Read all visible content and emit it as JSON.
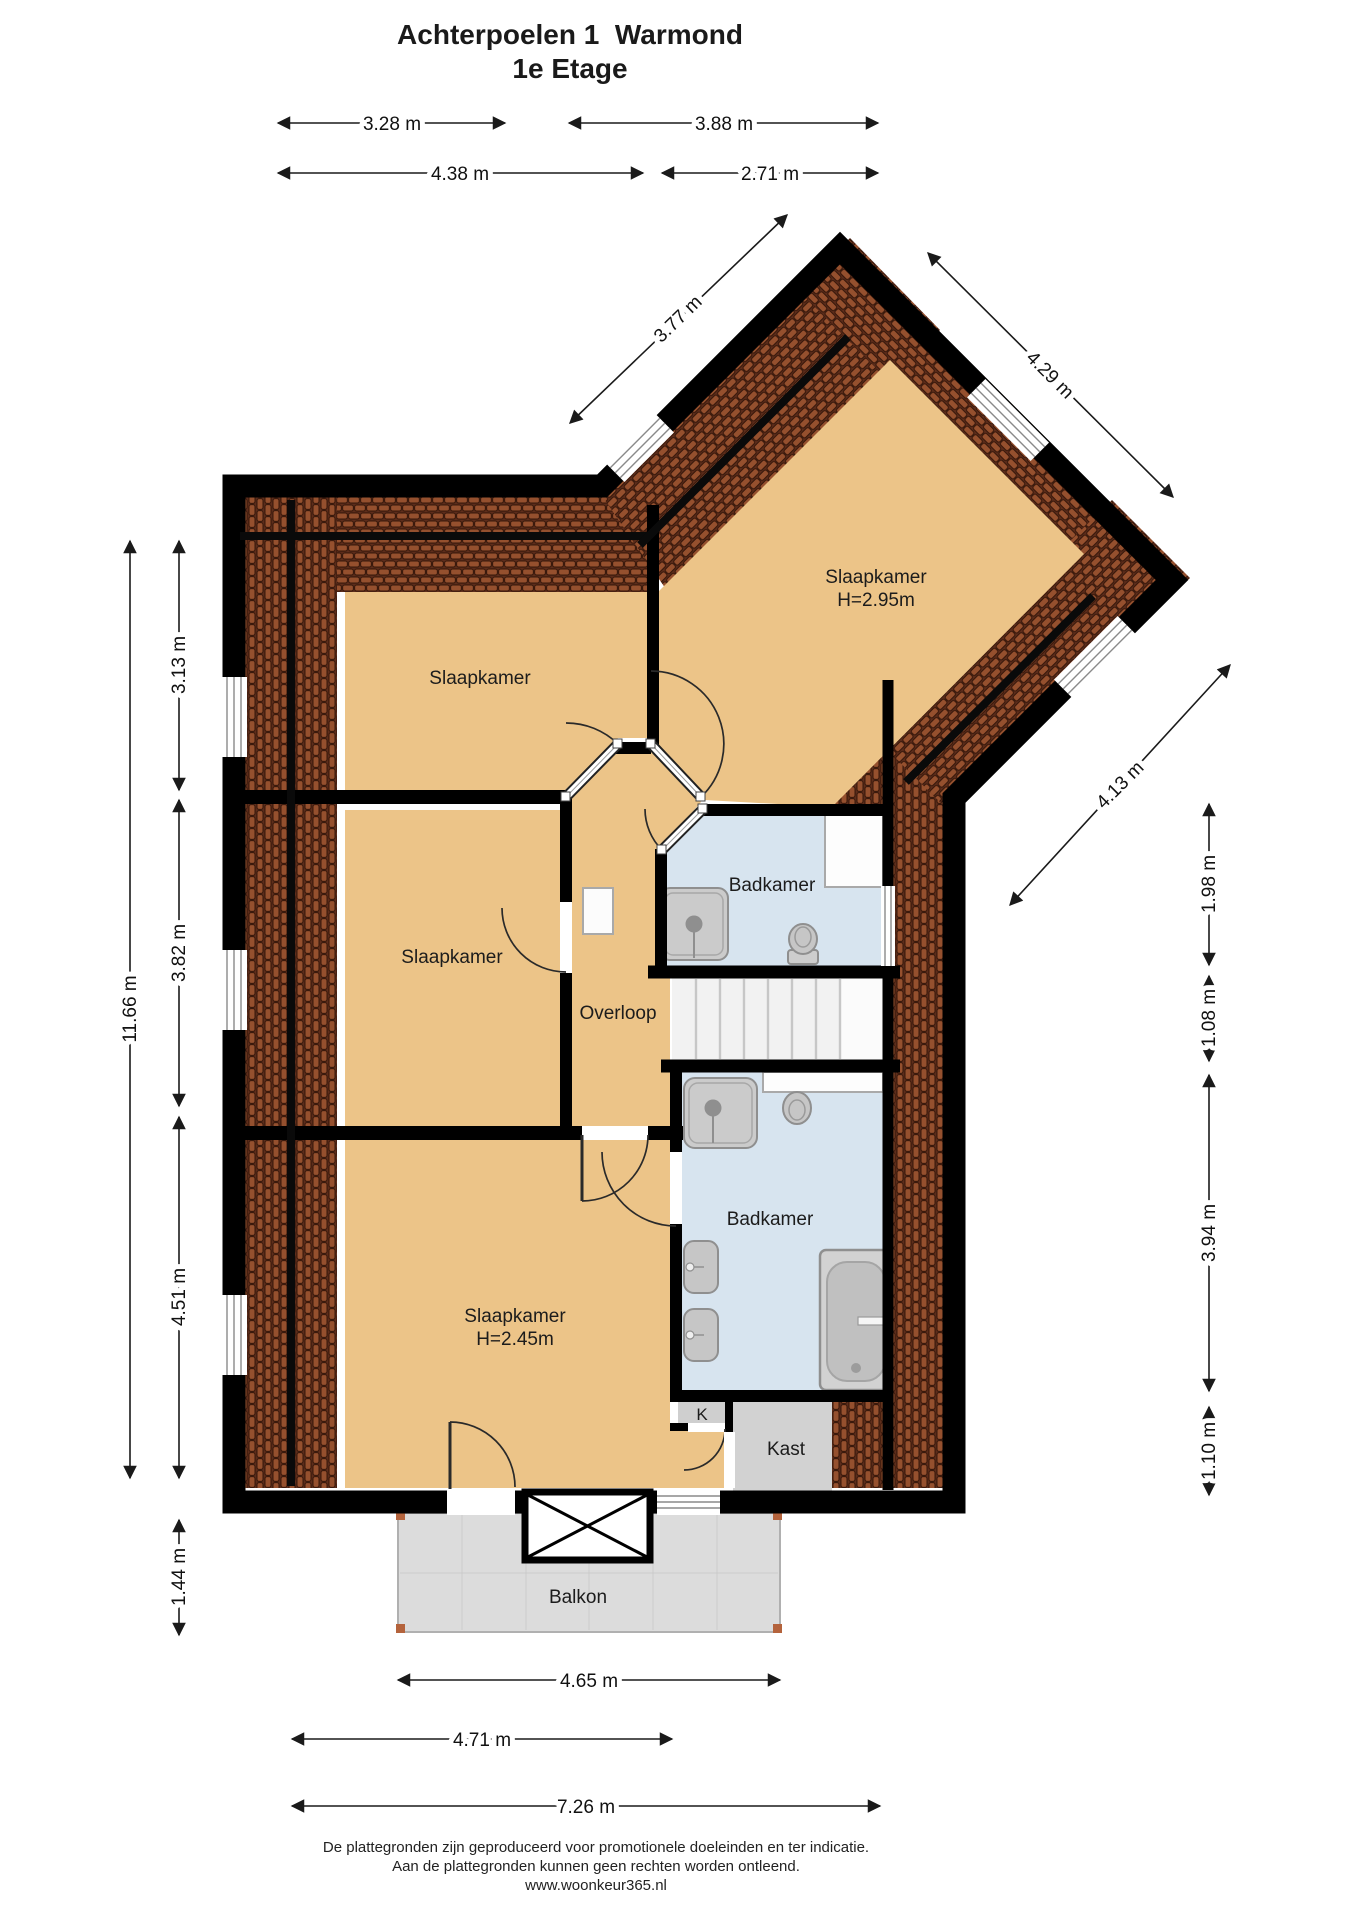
{
  "title": {
    "line1": "Achterpoelen 1  Warmond",
    "line2": "1e Etage"
  },
  "rooms": [
    {
      "name": "bedroom-top-left",
      "label": "Slaapkamer"
    },
    {
      "name": "bedroom-wing",
      "label": "Slaapkamer",
      "height": "H=2.95m"
    },
    {
      "name": "bedroom-middle-left",
      "label": "Slaapkamer"
    },
    {
      "name": "landing",
      "label": "Overloop"
    },
    {
      "name": "bathroom-top",
      "label": "Badkamer"
    },
    {
      "name": "bathroom-bottom",
      "label": "Badkamer"
    },
    {
      "name": "bedroom-large",
      "label": "Slaapkamer",
      "height": "H=2.45m"
    },
    {
      "name": "closet-small",
      "label": "K"
    },
    {
      "name": "closet",
      "label": "Kast"
    },
    {
      "name": "balcony",
      "label": "Balkon"
    }
  ],
  "dims": {
    "top": [
      "3.28 m",
      "3.88 m",
      "4.38 m",
      "2.71 m"
    ],
    "left": [
      "11.66 m",
      "3.13 m",
      "3.82 m",
      "4.51 m",
      "1.44 m"
    ],
    "right": [
      "1.98 m",
      "1.08 m",
      "3.94 m",
      "1.10 m"
    ],
    "bottom": [
      "4.65 m",
      "4.71 m",
      "7.26 m"
    ],
    "diagonal": [
      "3.77 m",
      "4.29 m",
      "4.13 m"
    ]
  },
  "footer": {
    "line1": "De plattegronden zijn geproduceerd voor promotionele doeleinden en ter indicatie.",
    "line2": "Aan de plattegronden kunnen geen rechten worden ontleend.",
    "line3": "www.woonkeur365.nl"
  },
  "colors": {
    "wall": "#000000",
    "floor_tan": "#ecc488",
    "bathroom_blue": "#d7e4ef",
    "roof_tiles": "#95502e",
    "balcony_gray": "#dcdcdc",
    "closet_gray": "#d2d2d2"
  }
}
